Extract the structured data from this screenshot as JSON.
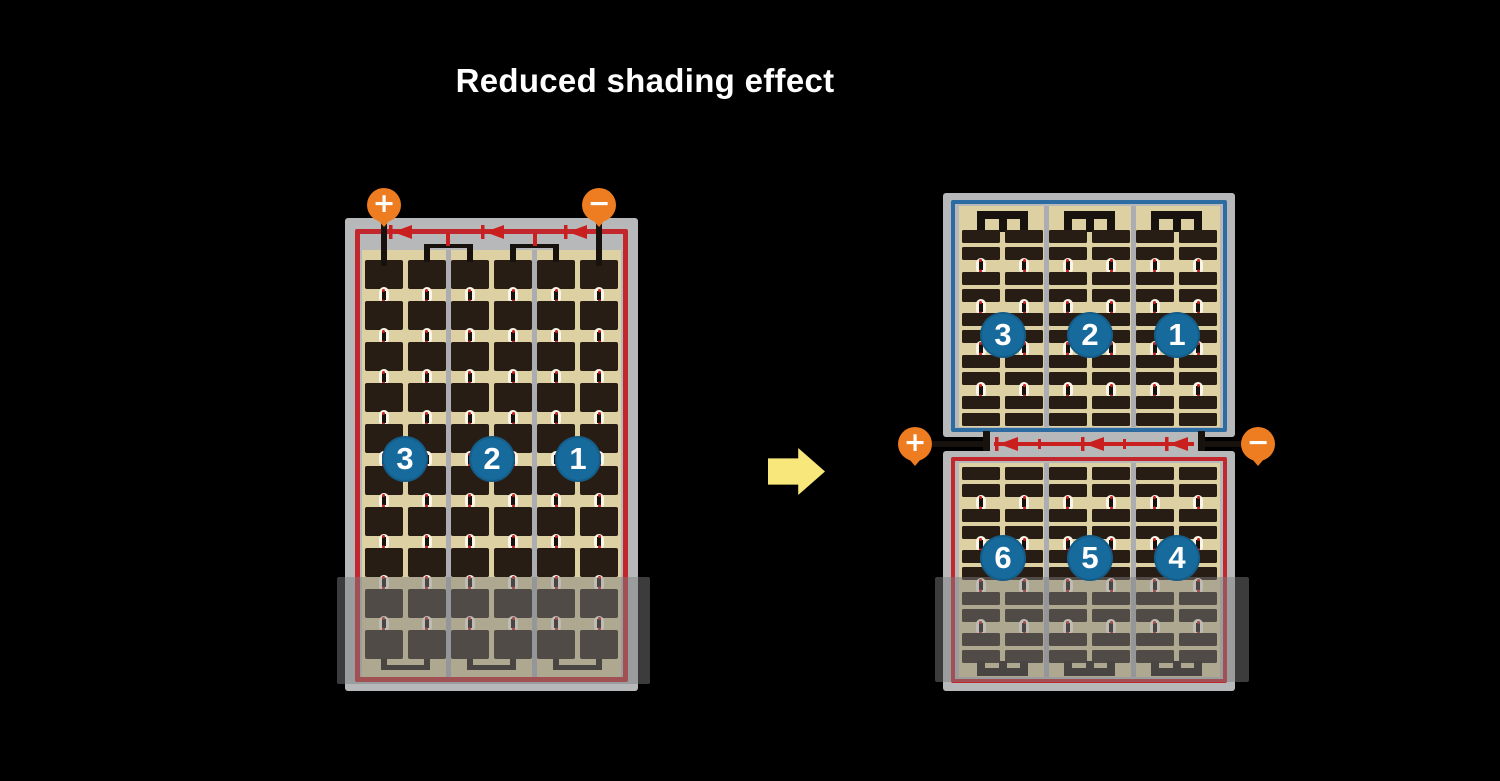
{
  "title": "Reduced shading effect",
  "terminals": {
    "positive": "+",
    "negative": "−"
  },
  "left_module": {
    "string_labels": [
      "3",
      "2",
      "1"
    ],
    "columns": 6,
    "rows": 10,
    "string_groups": 3,
    "bypass_diodes": 3,
    "shaded_bottom": true
  },
  "right_module": {
    "top_string_labels": [
      "3",
      "2",
      "1"
    ],
    "bottom_string_labels": [
      "6",
      "5",
      "4"
    ],
    "columns": 6,
    "bar_pair_blocks": 5,
    "string_groups": 3,
    "bypass_diodes": 3,
    "shaded_bottom": true
  },
  "colors": {
    "background": "#000000",
    "module_frame": "#b7b8ba",
    "cell_field": "#ddd0a2",
    "cell_dark": "#281d14",
    "divider": "#abadb3",
    "border_red": "#c1272d",
    "diode_red": "#c9201f",
    "border_blue": "#2d6ca2",
    "string_circle": "#176a9c",
    "terminal_orange": "#ee7c21",
    "arrow_yellow": "#f8e87b",
    "shade_overlay": "rgba(125,125,125,0.48)"
  }
}
